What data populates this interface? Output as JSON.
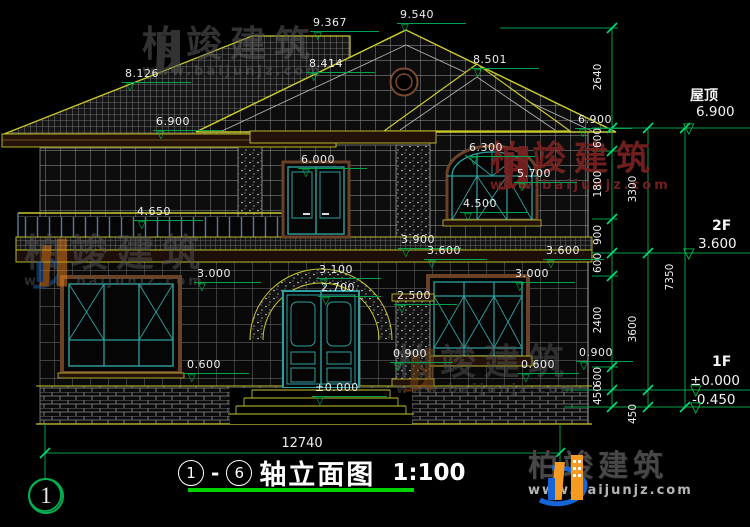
{
  "drawing": {
    "title": {
      "axis_from": "1",
      "axis_to": "6",
      "dash": "-",
      "name": "轴立面图",
      "scale": "1:100"
    },
    "axis_bubble": "1",
    "overall_width_dim": "12740",
    "levels": {
      "l9367": "9.367",
      "l9540": "9.540",
      "l8126": "8.126",
      "l8414": "8.414",
      "l8501": "8.501",
      "l6900_left": "6.900",
      "l6900_right": "6.900",
      "l6300": "6.300",
      "l6000": "6.000",
      "l5700": "5.700",
      "l4650": "4.650",
      "l4500": "4.500",
      "l3900": "3.900",
      "l3600_mid": "3.600",
      "l3600_right": "3.600",
      "l3100": "3.100",
      "l3000_left": "3.000",
      "l3000_right": "3.000",
      "l2700": "2.700",
      "l2500": "2.500",
      "l0900_left": "0.900",
      "l0900_right": "0.900",
      "l0600_left": "0.600",
      "l0600_right": "0.600",
      "l0000": "±0.000"
    },
    "right_labels": {
      "roof_name": "屋顶",
      "roof_level": "6.900",
      "f2_name": "2F",
      "f2_level": "3.600",
      "f1_name": "1F",
      "f1_level": "±0.000",
      "ground_offset": "-0.450"
    },
    "dim_chains": {
      "inner": [
        "2640",
        "600",
        "1800",
        "900",
        "600",
        "2400",
        "600",
        "450"
      ],
      "middle": [
        "3300",
        "3600",
        "450"
      ],
      "outer": [
        "7350"
      ]
    }
  },
  "watermark": {
    "brand": "柏竣建筑",
    "url": "www.baijunjz.com"
  },
  "logo": {
    "brand": "柏竣建筑",
    "url": "www.baijunjz.com"
  }
}
